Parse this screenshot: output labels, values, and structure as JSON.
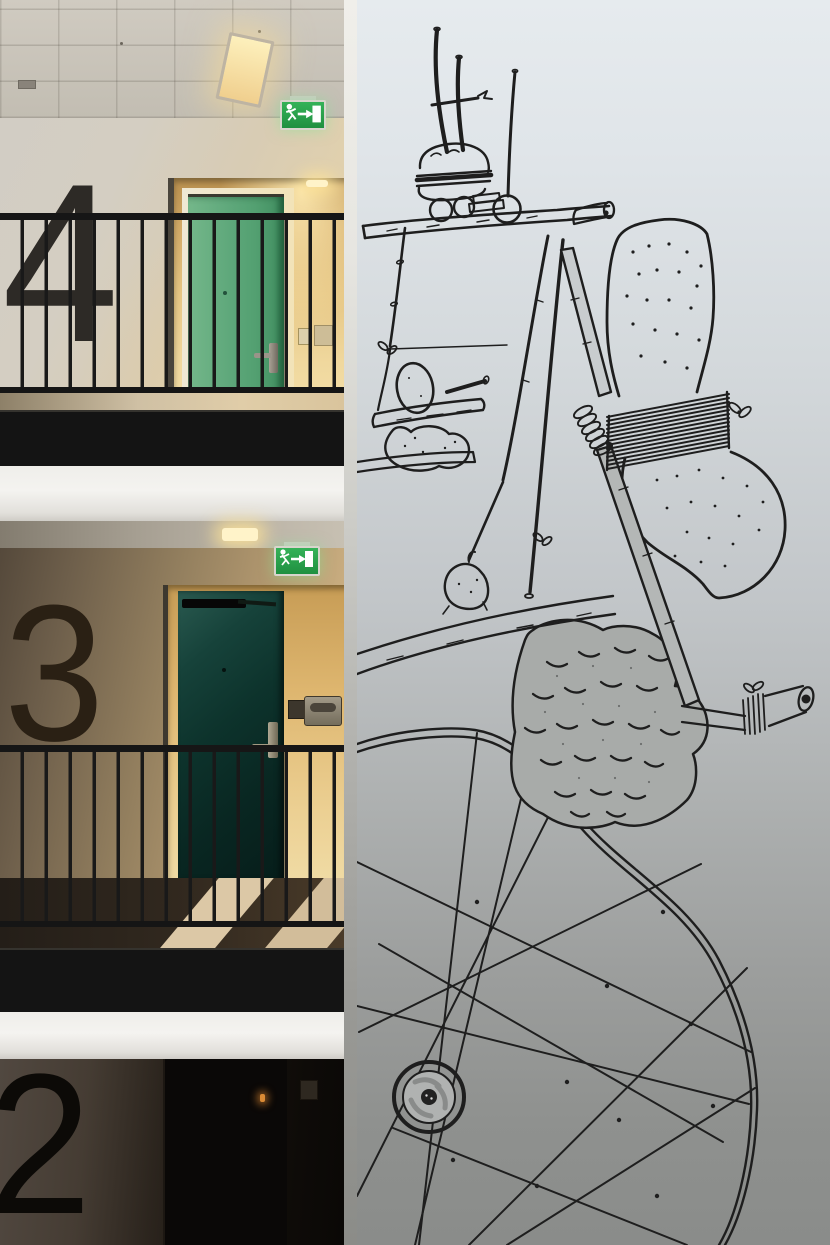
{
  "scene": {
    "setting": "apartment building atrium: numbered corridor floors beside a tall white wall covered with a black ink mural",
    "left_panel": "three stacked corridor floors with large painted floor numerals, metal railings, doors and emergency exit signs",
    "right_panel": "white wall with whimsical black line-drawing mural of a contraption with a wrapped sponge, pine-cone boulder and large spoked wheel"
  },
  "floors": [
    {
      "id": "floor-4",
      "numeral": "4",
      "door_color_name": "green",
      "door_hex": "#53a071",
      "sign": "emergency-exit",
      "lighting": "warm ceiling strip light"
    },
    {
      "id": "floor-3",
      "numeral": "3",
      "door_color_name": "dark teal",
      "door_hex": "#0d332c",
      "sign": "emergency-exit",
      "lighting": "warm recessed downlight"
    },
    {
      "id": "floor-2",
      "numeral": "2",
      "door_color_name": "dark, in shadow",
      "door_hex": "#0a0807",
      "sign": "",
      "lighting": "unlit"
    }
  ],
  "exit_sign": {
    "bg": "#26a34c",
    "pictograms": [
      "running-man",
      "arrow-right",
      "door"
    ]
  },
  "palette": {
    "ink": "#1e1e1e",
    "mural_wall_top": "#e6ebee",
    "mural_wall_bottom": "#8a8c8a",
    "ceiling": "#c9c4ba",
    "fascia_band": "#141414",
    "slab_band": "#f2f1ee",
    "railing": "#181818",
    "warm_wall": "#d8bd8e",
    "floor_mat_stripe": "#d8c4a2"
  },
  "mural": {
    "medium": "black marker line drawing on white wall",
    "elements": [
      "table plank with stacked burger-like buns",
      "two tall poles with crossbar",
      "ball on a long stick",
      "log cylinder on table end",
      "hanging stick with knots, string and bow",
      "egg resting on a swinging log shelf",
      "lumpy sack under the shelf",
      "a-frame legs with bow knot",
      "weight sack on a long diagonal plank",
      "large sponge wrapped with coiled twine and a bow",
      "spring coil on the handle stick",
      "pine-cone shaped textured boulder",
      "side stick with twine wrap and open pipe end",
      "large wheel with crossing spokes",
      "wheel hub with button centre"
    ]
  }
}
